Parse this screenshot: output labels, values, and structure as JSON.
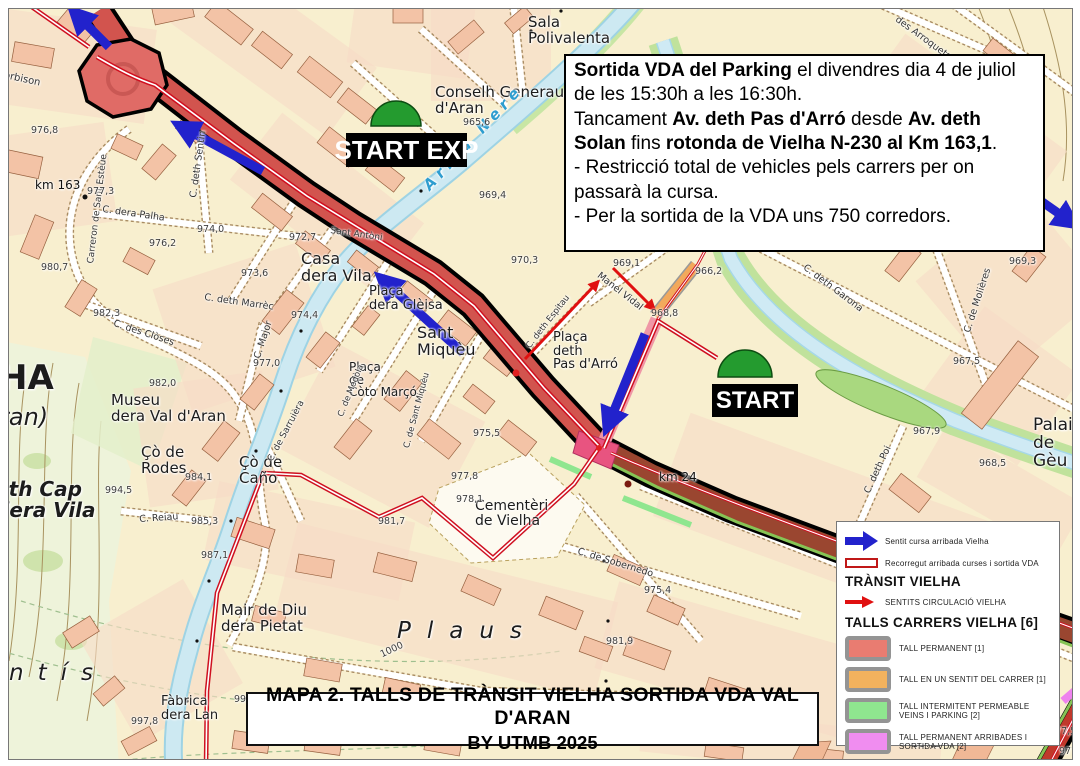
{
  "info_box": {
    "lines": [
      [
        {
          "text": "Sortida VDA del Parking",
          "bold": true
        },
        {
          "text": " el divendres dia 4 de juliol de les 15:30h a les 16:30h."
        }
      ],
      [
        {
          "text": "Tancament "
        },
        {
          "text": "Av. deth Pas d'Arró",
          "bold": true
        },
        {
          "text": " desde "
        },
        {
          "text": "Av. deth Solan",
          "bold": true
        },
        {
          "text": " fins "
        },
        {
          "text": "rotonda de Vielha N-230 al Km 163,1",
          "bold": true
        },
        {
          "text": "."
        }
      ],
      [
        {
          "text": "- Restricció total de vehicles pels carrers per on passarà la cursa."
        }
      ],
      [
        {
          "text": "- Per la sortida de la VDA uns 750 corredors."
        }
      ]
    ]
  },
  "title_box": {
    "line1": "MAPA 2. TALLS DE TRÀNSIT VIELHA SORTIDA VDA VAL D'ARAN",
    "line2": "BY UTMB 2025"
  },
  "start_markers": [
    {
      "label": "START EXP"
    },
    {
      "label": "START"
    }
  ],
  "legend": {
    "items_top": [
      {
        "icon": "blue-arrow-icon",
        "label": "Sentit cursa arribada Vielha"
      },
      {
        "icon": "route-bar-icon",
        "label": "Recorregut arribada curses i sortida VDA"
      }
    ],
    "transit_heading": "TRÀNSIT VIELHA",
    "transit_items": [
      {
        "icon": "red-arrow-icon",
        "label": "SENTITS CIRCULACIÓ VIELHA"
      }
    ],
    "talls_heading": "TALLS CARRERS VIELHA [6]",
    "talls_items": [
      {
        "color": "#e97c71",
        "label": "TALL PERMANENT [1]"
      },
      {
        "color": "#f2b25e",
        "label": "TALL EN UN SENTIT DEL CARRER [1]"
      },
      {
        "color": "#8fe68f",
        "label": "TALL INTERMITENT PERMEABLE VEINS I PARKING [2]"
      },
      {
        "color": "#f08df0",
        "label": "TALL PERMANENT ARRIBADES I SORTIDA VDA [2]"
      }
    ]
  },
  "colors": {
    "race_arrow_blue": "#2222cc",
    "circulation_red": "#e01010",
    "route_red": "#cf1020",
    "closed_road_red": "#d2544e",
    "closed_road_dark": "#9a4630",
    "river_blue": "#cde9f2",
    "start_green": "#249b2f"
  },
  "map": {
    "labels": [
      {
        "text": "Sala\nPolivalenta",
        "x": 527,
        "y": 14,
        "size": 15,
        "cls": "p"
      },
      {
        "text": "Conselh Generau\nd'Aran",
        "x": 434,
        "y": 84,
        "size": 15,
        "cls": "p"
      },
      {
        "text": "Arriu Nere",
        "x": 420,
        "y": 182,
        "size": 15,
        "cls": "w",
        "rot": -47,
        "ls": 5
      },
      {
        "text": "Casa\ndera Vila",
        "x": 300,
        "y": 250,
        "size": 16,
        "cls": "p"
      },
      {
        "text": "Plaça\ndera Glèisa",
        "x": 368,
        "y": 284,
        "size": 13,
        "cls": "p"
      },
      {
        "text": "Sant\nMiquèu",
        "x": 416,
        "y": 324,
        "size": 16,
        "cls": "p"
      },
      {
        "text": "Plaça\nde\nCòto Marçó",
        "x": 348,
        "y": 360,
        "size": 12,
        "cls": "p"
      },
      {
        "text": "Museu\ndera Val d'Aran",
        "x": 110,
        "y": 392,
        "size": 15,
        "cls": "p"
      },
      {
        "text": "Çò de\nRodes",
        "x": 140,
        "y": 444,
        "size": 15,
        "cls": "p"
      },
      {
        "text": "Çò de\nCaño",
        "x": 238,
        "y": 454,
        "size": 15,
        "cls": "p"
      },
      {
        "text": "Eth Cap\ndera Vila",
        "x": -6,
        "y": 478,
        "size": 20,
        "cls": "p bi"
      },
      {
        "text": "Mair de Diu\ndera Pietat",
        "x": 220,
        "y": 602,
        "size": 15,
        "cls": "p"
      },
      {
        "text": "Fàbrica\ndera Lan",
        "x": 160,
        "y": 694,
        "size": 13,
        "cls": "p"
      },
      {
        "text": "Cementèri\nde Vielha",
        "x": 474,
        "y": 498,
        "size": 14,
        "cls": "p"
      },
      {
        "text": "Plaça\ndeth\nPas d'Arró",
        "x": 552,
        "y": 330,
        "size": 13,
        "cls": "p"
      },
      {
        "text": "Palai\nde Gèu",
        "x": 1032,
        "y": 416,
        "size": 17,
        "cls": "p"
      },
      {
        "text": "HA",
        "x": -2,
        "y": 360,
        "size": 34,
        "cls": "p b"
      },
      {
        "text": "ran)",
        "x": -2,
        "y": 404,
        "size": 24,
        "cls": "p i"
      },
      {
        "text": "ntís",
        "x": 8,
        "y": 660,
        "size": 23,
        "cls": "p i",
        "ls": 14
      },
      {
        "text": "Plaus",
        "x": 396,
        "y": 618,
        "size": 23,
        "cls": "p i",
        "ls": 16
      },
      {
        "text": "orbison",
        "x": 4,
        "y": 70,
        "size": 10,
        "cls": "s",
        "rot": 12
      },
      {
        "text": "Carreron de Sant Estèue",
        "x": 86,
        "y": 262,
        "size": 9,
        "cls": "s",
        "rot": -83
      },
      {
        "text": "C. dera Palha",
        "x": 102,
        "y": 204,
        "size": 9.5,
        "cls": "s",
        "rot": 8
      },
      {
        "text": "C. deth Sentin",
        "x": 188,
        "y": 196,
        "size": 9.5,
        "cls": "s",
        "rot": -82
      },
      {
        "text": "C. des Clòses",
        "x": 114,
        "y": 318,
        "size": 9.5,
        "cls": "s",
        "rot": 18
      },
      {
        "text": "C. Major",
        "x": 252,
        "y": 356,
        "size": 9.5,
        "cls": "s",
        "rot": -72
      },
      {
        "text": "C. deth Marrèc",
        "x": 204,
        "y": 292,
        "size": 9.5,
        "cls": "s",
        "rot": 8
      },
      {
        "text": "C. de Sarruièra",
        "x": 266,
        "y": 458,
        "size": 9,
        "cls": "s",
        "rot": -62
      },
      {
        "text": "C. Reiau",
        "x": 138,
        "y": 514,
        "size": 9.5,
        "cls": "s",
        "rot": -4
      },
      {
        "text": "C. de Medòla",
        "x": 336,
        "y": 414,
        "size": 8.5,
        "cls": "s",
        "rot": -68
      },
      {
        "text": "C. de Sant Miquèu",
        "x": 402,
        "y": 446,
        "size": 8.5,
        "cls": "s",
        "rot": -75
      },
      {
        "text": "C. de Sobernedo",
        "x": 578,
        "y": 546,
        "size": 9.5,
        "cls": "s",
        "rot": 17
      },
      {
        "text": "C. de Molières",
        "x": 962,
        "y": 330,
        "size": 9.5,
        "cls": "s",
        "rot": -72
      },
      {
        "text": "C. deth Poi",
        "x": 862,
        "y": 490,
        "size": 9.5,
        "cls": "s",
        "rot": -65
      },
      {
        "text": "C. deth Garona",
        "x": 806,
        "y": 262,
        "size": 9.5,
        "cls": "s",
        "rot": 37
      },
      {
        "text": "des Arroquets",
        "x": 898,
        "y": 14,
        "size": 9.5,
        "cls": "s",
        "rot": 36
      },
      {
        "text": "Manel Vidal",
        "x": 600,
        "y": 270,
        "size": 9.5,
        "cls": "s",
        "rot": 38
      },
      {
        "text": "C. deth Espitau",
        "x": 524,
        "y": 344,
        "size": 8.5,
        "cls": "s",
        "rot": -52
      },
      {
        "text": "Sant Antòni",
        "x": 330,
        "y": 226,
        "size": 9,
        "cls": "s",
        "rot": 8
      },
      {
        "text": "km 163",
        "x": 34,
        "y": 178,
        "size": 12,
        "cls": "km"
      },
      {
        "text": "km 24",
        "x": 658,
        "y": 470,
        "size": 12,
        "cls": "km"
      },
      {
        "text": "976,8",
        "x": 30,
        "y": 125,
        "size": 9.5,
        "cls": "e"
      },
      {
        "text": "977,3",
        "x": 86,
        "y": 186,
        "size": 9.5,
        "cls": "e"
      },
      {
        "text": "974,0",
        "x": 196,
        "y": 224,
        "size": 9.5,
        "cls": "e"
      },
      {
        "text": "976,2",
        "x": 148,
        "y": 238,
        "size": 9.5,
        "cls": "e"
      },
      {
        "text": "972,7",
        "x": 288,
        "y": 232,
        "size": 9.5,
        "cls": "e"
      },
      {
        "text": "973,6",
        "x": 240,
        "y": 268,
        "size": 9.5,
        "cls": "e"
      },
      {
        "text": "970,3",
        "x": 510,
        "y": 255,
        "size": 9.5,
        "cls": "e"
      },
      {
        "text": "974,4",
        "x": 290,
        "y": 310,
        "size": 9.5,
        "cls": "e"
      },
      {
        "text": "977,0",
        "x": 252,
        "y": 358,
        "size": 9.5,
        "cls": "e"
      },
      {
        "text": "982,0",
        "x": 148,
        "y": 378,
        "size": 9.5,
        "cls": "e"
      },
      {
        "text": "994,5",
        "x": 104,
        "y": 485,
        "size": 9.5,
        "cls": "e"
      },
      {
        "text": "984,1",
        "x": 184,
        "y": 472,
        "size": 9.5,
        "cls": "e"
      },
      {
        "text": "985,3",
        "x": 190,
        "y": 516,
        "size": 9.5,
        "cls": "e"
      },
      {
        "text": "987,1",
        "x": 200,
        "y": 550,
        "size": 9.5,
        "cls": "e"
      },
      {
        "text": "997,8",
        "x": 130,
        "y": 716,
        "size": 9.5,
        "cls": "e"
      },
      {
        "text": "981,7",
        "x": 377,
        "y": 516,
        "size": 9.5,
        "cls": "e"
      },
      {
        "text": "977,8",
        "x": 450,
        "y": 471,
        "size": 9.5,
        "cls": "e"
      },
      {
        "text": "978,1",
        "x": 455,
        "y": 494,
        "size": 9.5,
        "cls": "e"
      },
      {
        "text": "975,4",
        "x": 643,
        "y": 585,
        "size": 9.5,
        "cls": "e"
      },
      {
        "text": "981,9",
        "x": 605,
        "y": 636,
        "size": 9.5,
        "cls": "e"
      },
      {
        "text": "991,3",
        "x": 233,
        "y": 694,
        "size": 9.5,
        "cls": "e"
      },
      {
        "text": "987,2",
        "x": 912,
        "y": 739,
        "size": 9.5,
        "cls": "e"
      },
      {
        "text": "975,5",
        "x": 472,
        "y": 428,
        "size": 9.5,
        "cls": "e"
      },
      {
        "text": "980,7",
        "x": 40,
        "y": 262,
        "size": 9.5,
        "cls": "e"
      },
      {
        "text": "982,3",
        "x": 92,
        "y": 308,
        "size": 9.5,
        "cls": "e"
      },
      {
        "text": "969,4",
        "x": 478,
        "y": 190,
        "size": 9.5,
        "cls": "e"
      },
      {
        "text": "965,6",
        "x": 462,
        "y": 117,
        "size": 9.5,
        "cls": "e"
      },
      {
        "text": "968,9",
        "x": 373,
        "y": 152,
        "size": 9.5,
        "cls": "e"
      },
      {
        "text": "968,8",
        "x": 650,
        "y": 308,
        "size": 9.5,
        "cls": "e"
      },
      {
        "text": "969,1",
        "x": 612,
        "y": 258,
        "size": 9.5,
        "cls": "e"
      },
      {
        "text": "966,2",
        "x": 694,
        "y": 266,
        "size": 9.5,
        "cls": "e"
      },
      {
        "text": "969,3",
        "x": 1008,
        "y": 256,
        "size": 9.5,
        "cls": "e"
      },
      {
        "text": "967,5",
        "x": 952,
        "y": 356,
        "size": 9.5,
        "cls": "e"
      },
      {
        "text": "967,9",
        "x": 912,
        "y": 426,
        "size": 9.5,
        "cls": "e"
      },
      {
        "text": "968,5",
        "x": 978,
        "y": 458,
        "size": 9.5,
        "cls": "e"
      },
      {
        "text": "977,5",
        "x": 1048,
        "y": 726,
        "size": 9.5,
        "cls": "e"
      },
      {
        "text": "977,",
        "x": 1058,
        "y": 746,
        "size": 9.5,
        "cls": "e"
      },
      {
        "text": "1000",
        "x": 378,
        "y": 650,
        "size": 9.5,
        "cls": "e",
        "rot": -25
      }
    ]
  }
}
